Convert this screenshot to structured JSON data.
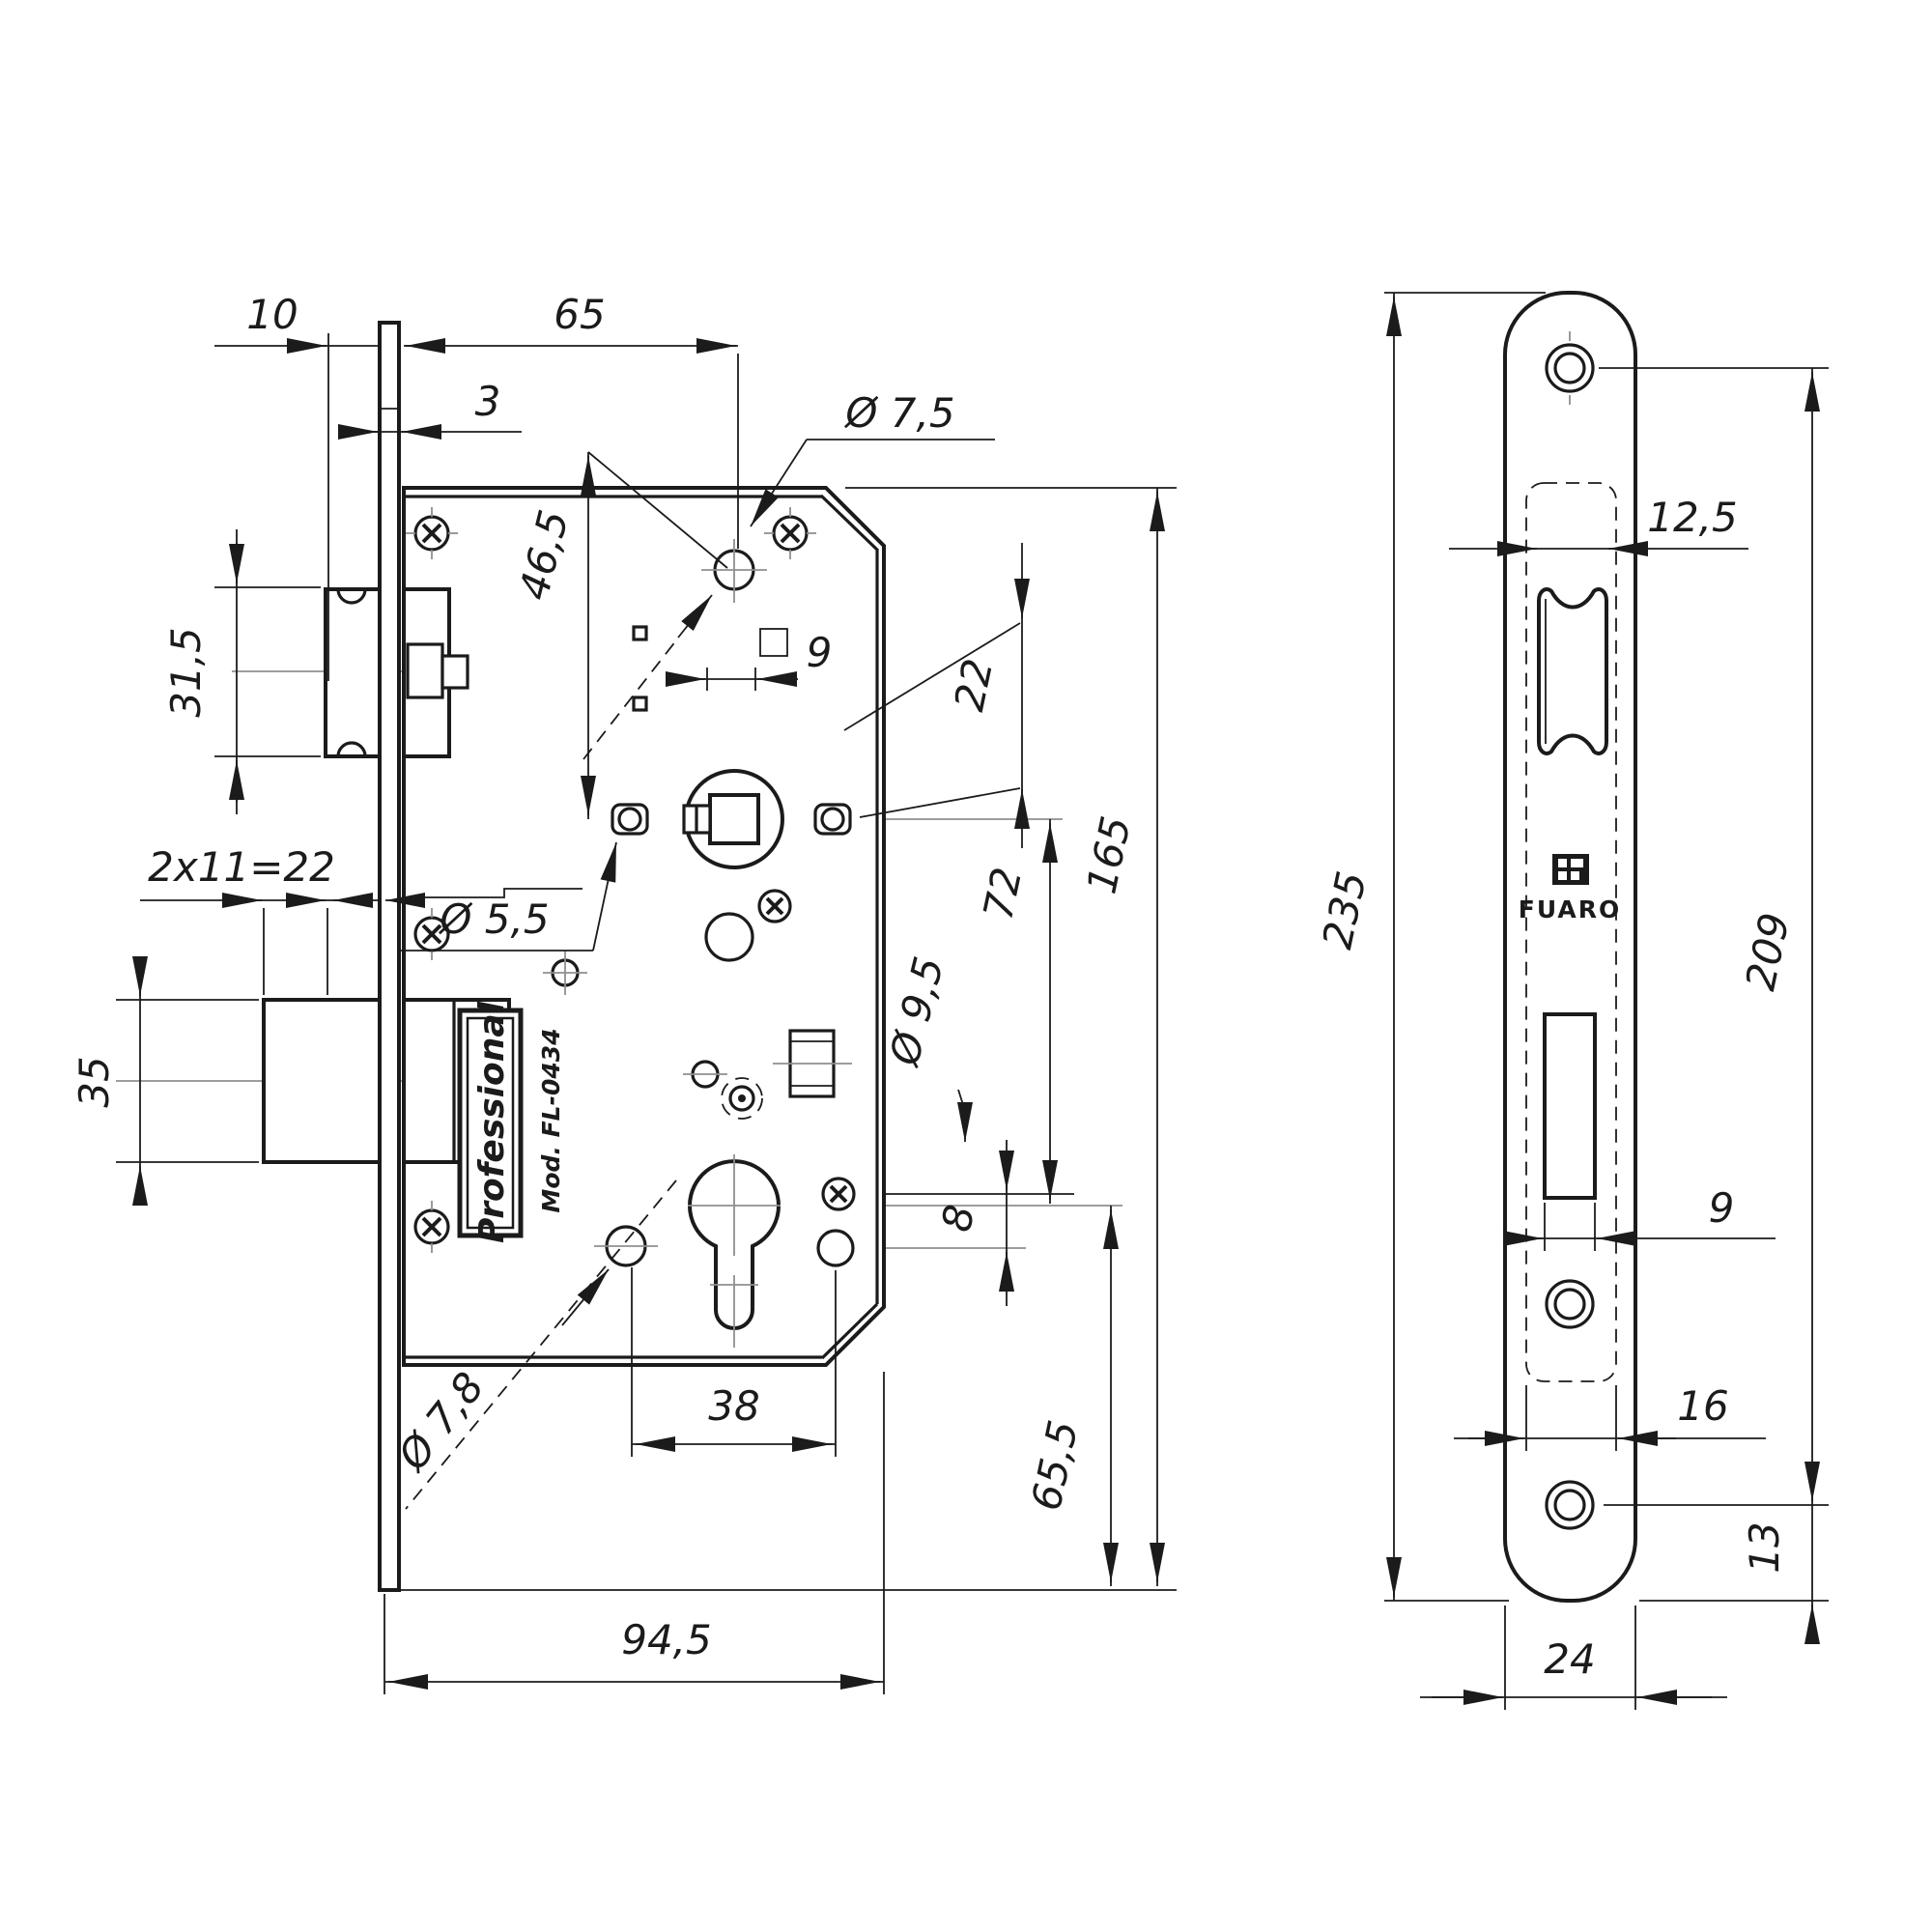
{
  "left_view": {
    "labels": {
      "brand_plate": "Professional",
      "model": "Mod. FL-0434"
    },
    "dimensions": {
      "backset_offset": "10",
      "backset": "65",
      "faceplate_thickness": "3",
      "top_hole_diameter": "Ø 7,5",
      "hub_to_hole": "46,5",
      "latch_height": "31,5",
      "spindle_square": "9",
      "offset_22": "22",
      "bolt_throw": "2x11=22",
      "screw_hole_diameter": "Ø 5,5",
      "body_height": "165",
      "hub_to_cylinder": "72",
      "deadbolt_height": "35",
      "hole_9_5": "Ø 9,5",
      "offset_8": "8",
      "hole_7_8": "Ø 7,8",
      "cylinder_spacing": "38",
      "cylinder_to_bottom": "65,5",
      "body_width": "94,5"
    }
  },
  "right_view": {
    "labels": {
      "brand": "FUARO"
    },
    "dimensions": {
      "latch_slot_width": "12,5",
      "faceplate_length": "235",
      "screw_spacing": "209",
      "deadbolt_slot_width": "9",
      "cutout_width": "16",
      "screw_to_end": "13",
      "faceplate_width": "24"
    }
  }
}
